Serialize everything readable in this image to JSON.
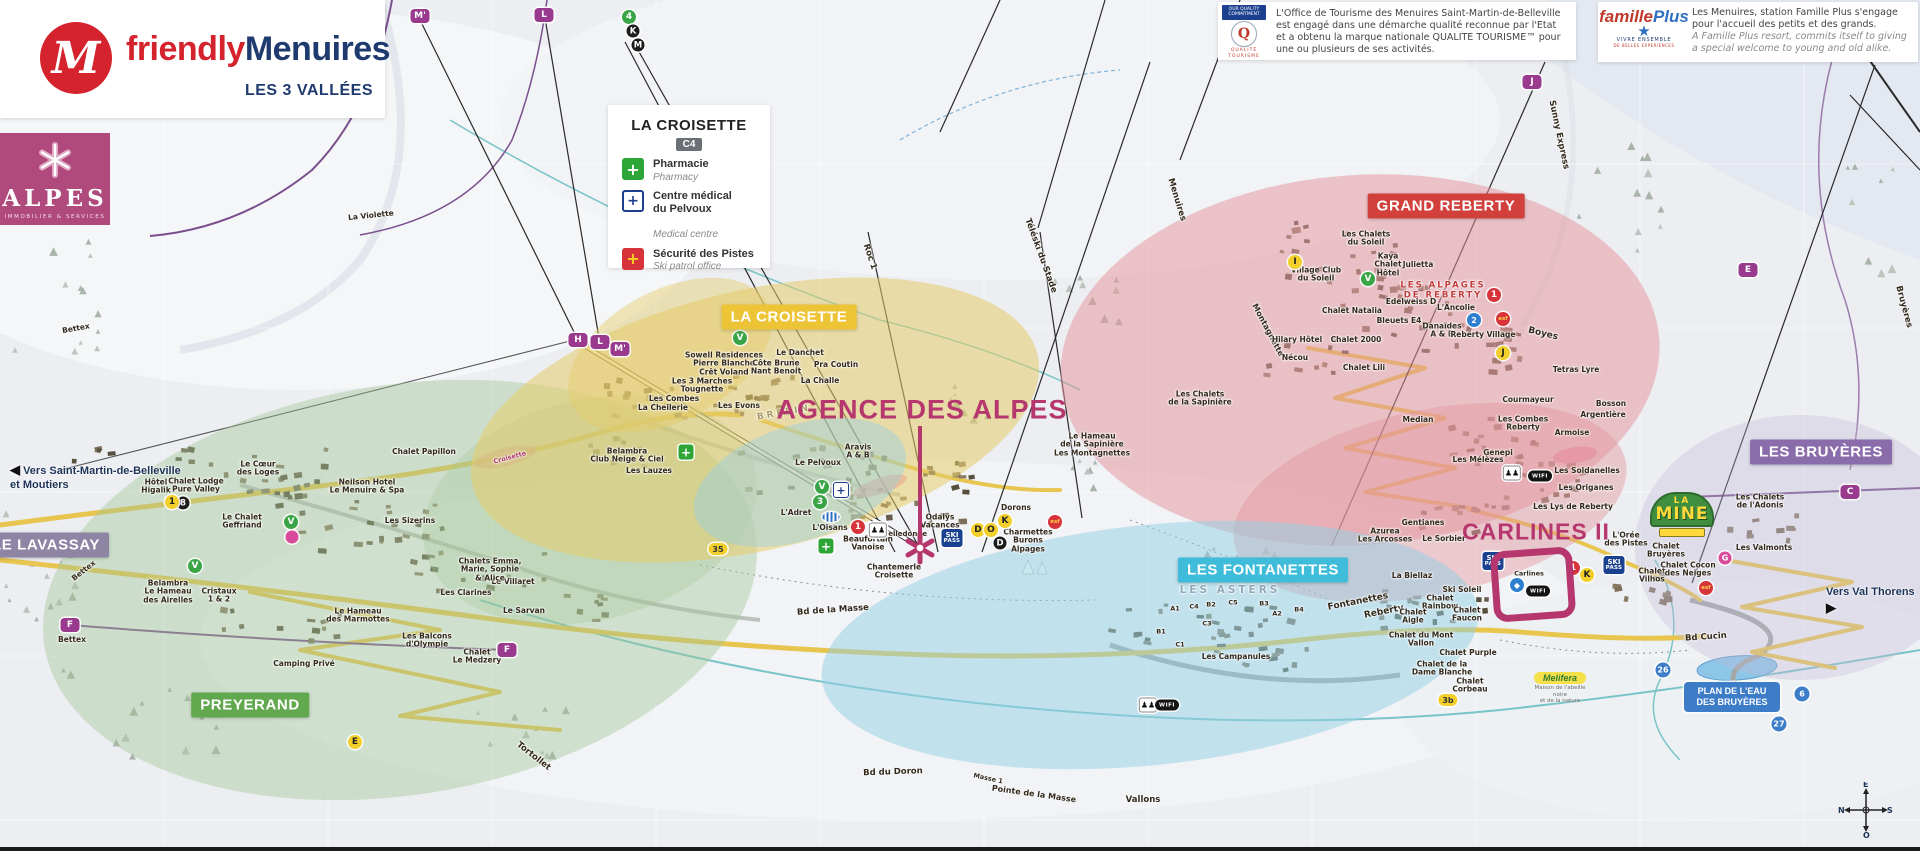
{
  "branding": {
    "m": "M",
    "friendly": "friendly",
    "menuires": "Menuires",
    "tagline": "LES 3 VALLÉES"
  },
  "alpes": {
    "title": "ALPES",
    "subtitle": "IMMOBILIER & SERVICES"
  },
  "legend": {
    "title": "LA CROISETTE",
    "grid_ref": "C4",
    "items": [
      {
        "fr": "Pharmacie",
        "en": "Pharmacy",
        "icon": "pharmacy-cross"
      },
      {
        "fr": "Centre médical\ndu Pelvoux",
        "en": "Medical centre",
        "icon": "medical-cross"
      },
      {
        "fr": "Sécurité des Pistes",
        "en": "Ski patrol office",
        "icon": "ski-patrol-cross"
      }
    ],
    "cross_glyph": "+"
  },
  "quality": {
    "badge_line1": "OUR QUALITY",
    "badge_line2": "COMMITMENT",
    "q": "Q",
    "logo_line1": "QUALITÉ",
    "logo_line2": "TOURISME",
    "text": "L'Office de Tourisme des Menuires Saint-Martin-de-Belleville est engagé dans une démarche qualité reconnue par l'Etat et a obtenu la marque nationale QUALITE TOURISME™ pour une ou plusieurs de ses activités."
  },
  "famille_plus": {
    "logo_f": "famille",
    "logo_p": "Plus",
    "star": "★",
    "sub1": "VIVRE ENSEMBLE",
    "sub2": "DE BELLES EXPERIENCES",
    "text_fr": "Les Menuires, station Famille Plus s'engage pour l'accueil des petits et des grands.",
    "text_en": "A Famille Plus resort, commits itself to giving a special welcome to young and old alike."
  },
  "callouts": {
    "agence": "AGENCE DES ALPES",
    "carlines": "CARLINES II"
  },
  "special": {
    "la_mine": {
      "l1": "LA",
      "l2": "MINE"
    },
    "plan_eau": {
      "l1": "PLAN DE L'EAU",
      "l2": "DES BRUYÈRES"
    },
    "melifera": {
      "name": "Melifera",
      "sub1": "Maison de l'abeille noire",
      "sub2": "et de la nature"
    },
    "ski_pass": {
      "l1": "SKI",
      "l2": "PASS"
    },
    "wifi": "WIFI",
    "people_glyph": "♟♟",
    "vers_left": {
      "arrow": "◀",
      "l1": "Vers Saint-Martin-de-Belleville",
      "l2": "et Moutiers"
    },
    "vers_right": {
      "label": "Vers Val Thorens",
      "arrow": "▶"
    },
    "compass": {
      "top": "E",
      "right": "S",
      "bottom": "O",
      "left": "N"
    }
  },
  "area_banners": [
    {
      "t": "LA CROISETTE",
      "x": 789,
      "y": 317,
      "bg": "#eec437",
      "n": "banner-la-croisette"
    },
    {
      "t": "GRAND REBERTY",
      "x": 1446,
      "y": 206,
      "bg": "#d2403c",
      "n": "banner-grand-reberty"
    },
    {
      "t": "LES BRUYÈRES",
      "x": 1821,
      "y": 452,
      "bg": "#8b6cab",
      "n": "banner-les-bruyeres"
    },
    {
      "t": "LES FONTANETTES",
      "x": 1263,
      "y": 570,
      "bg": "#3fbcd9",
      "n": "banner-les-fontanettes"
    },
    {
      "t": "PREYERAND",
      "x": 250,
      "y": 705,
      "bg": "#61a84f",
      "n": "banner-preyerand"
    },
    {
      "t": "LE LAVASSAY",
      "x": 46,
      "y": 545,
      "bg": "#8d85a3",
      "n": "banner-le-lavassay"
    }
  ],
  "map_labels": [
    {
      "t": "Le Cœur\ndes Loges",
      "x": 258,
      "y": 469
    },
    {
      "t": "Hôtel\nHigalik",
      "x": 156,
      "y": 487
    },
    {
      "t": "Chalet Lodge\nPure Valley",
      "x": 196,
      "y": 486
    },
    {
      "t": "Le Chalet\nGeffriand",
      "x": 242,
      "y": 522
    },
    {
      "t": "Belambra\nLe Hameau\ndes Airelles",
      "x": 168,
      "y": 592
    },
    {
      "t": "Cristaux\n1 & 2",
      "x": 219,
      "y": 596
    },
    {
      "t": "Le Hameau\ndes Marmottes",
      "x": 358,
      "y": 616
    },
    {
      "t": "Les Balcons\nd'Olympie",
      "x": 427,
      "y": 641
    },
    {
      "t": "Chalet\nLe Medzery",
      "x": 477,
      "y": 657
    },
    {
      "t": "Le Sarvan",
      "x": 524,
      "y": 611
    },
    {
      "t": "Camping Privé",
      "x": 304,
      "y": 664
    },
    {
      "t": "Les Clarines",
      "x": 466,
      "y": 593
    },
    {
      "t": "Le Villaret",
      "x": 513,
      "y": 582
    },
    {
      "t": "Chalets Emma,\nMarie, Sophie\n& Alice",
      "x": 490,
      "y": 570
    },
    {
      "t": "Les Sizerins",
      "x": 410,
      "y": 521
    },
    {
      "t": "Neilson Hotel\nLe Menuire & Spa",
      "x": 367,
      "y": 487
    },
    {
      "t": "Chalet Papillon",
      "x": 424,
      "y": 452
    },
    {
      "t": "Belambra\nClub Neige & Ciel",
      "x": 627,
      "y": 456
    },
    {
      "t": "Les Lauzes",
      "x": 649,
      "y": 471
    },
    {
      "t": "Bettex",
      "x": 76,
      "y": 329,
      "r": -10
    },
    {
      "t": "Bettex",
      "x": 84,
      "y": 571,
      "r": -38
    },
    {
      "t": "Bettex",
      "x": 72,
      "y": 640
    },
    {
      "t": "La Violette",
      "x": 371,
      "y": 216,
      "r": -6
    },
    {
      "t": "Tortollet",
      "x": 533,
      "y": 757,
      "r": 38,
      "s": 8.5
    },
    {
      "t": "Bd de la Masse",
      "x": 833,
      "y": 611,
      "r": -4,
      "s": 8.5
    },
    {
      "t": "Bd du Doron",
      "x": 893,
      "y": 773,
      "r": -2,
      "s": 8.5
    },
    {
      "t": "Vallons",
      "x": 1143,
      "y": 801,
      "s": 8.5
    },
    {
      "t": "Pointe de la Masse",
      "x": 1034,
      "y": 794,
      "r": 8,
      "s": 8
    },
    {
      "t": "Masse 1",
      "x": 988,
      "y": 779,
      "r": 12,
      "s": 6.5
    },
    {
      "t": "Sowell Residences\nPierre Blanche\nCrêt Voland",
      "x": 724,
      "y": 364
    },
    {
      "t": "Les 3 Marches\nTougnette",
      "x": 702,
      "y": 386
    },
    {
      "t": "Les Combes",
      "x": 674,
      "y": 399
    },
    {
      "t": "La Cheilerie",
      "x": 663,
      "y": 408
    },
    {
      "t": "Les Evons",
      "x": 739,
      "y": 406
    },
    {
      "t": "Le Danchet",
      "x": 800,
      "y": 353
    },
    {
      "t": "Côte Brune\nNant Benoit",
      "x": 776,
      "y": 368
    },
    {
      "t": "Pra Coutin",
      "x": 836,
      "y": 365
    },
    {
      "t": "La Challe",
      "x": 820,
      "y": 381
    },
    {
      "t": "BRELIN",
      "x": 784,
      "y": 413,
      "r": -10,
      "c": "#a89a66",
      "ls": 3,
      "s": 9
    },
    {
      "t": "L'Adret",
      "x": 796,
      "y": 513
    },
    {
      "t": "Le Pelvoux",
      "x": 818,
      "y": 463
    },
    {
      "t": "Aravis\nA & B",
      "x": 858,
      "y": 452
    },
    {
      "t": "Le Hameau\nde la Sapinière\nLes Montagnettes",
      "x": 1092,
      "y": 445
    },
    {
      "t": "Les Chalets\nde la Sapinière",
      "x": 1200,
      "y": 399
    },
    {
      "t": "Odalys\nVacances",
      "x": 940,
      "y": 522
    },
    {
      "t": "Belledonne",
      "x": 905,
      "y": 535,
      "s": 7
    },
    {
      "t": "Beaufortain\nVanoise",
      "x": 868,
      "y": 544
    },
    {
      "t": "Dorons",
      "x": 1016,
      "y": 508
    },
    {
      "t": "Charmettes\nBurons\nAlpages",
      "x": 1028,
      "y": 541
    },
    {
      "t": "L'Oisans",
      "x": 830,
      "y": 528
    },
    {
      "t": "Chantemerle\nCroisette",
      "x": 894,
      "y": 572
    },
    {
      "t": "Croisette",
      "x": 510,
      "y": 458,
      "r": -15,
      "s": 6.5,
      "c": "#b03a6d"
    },
    {
      "t": "Roc 1",
      "x": 869,
      "y": 257,
      "r": 72,
      "s": 8.5
    },
    {
      "t": "Téléski du Stade",
      "x": 1040,
      "y": 256,
      "r": 70,
      "s": 8.5
    },
    {
      "t": "Menuires",
      "x": 1176,
      "y": 200,
      "r": 73,
      "s": 8.5
    },
    {
      "t": "Sunny Express",
      "x": 1558,
      "y": 135,
      "r": 78,
      "s": 8.5
    },
    {
      "t": "Bruyères",
      "x": 1903,
      "y": 307,
      "r": 75,
      "s": 8.5
    },
    {
      "t": "Montagnette",
      "x": 1268,
      "y": 330,
      "r": 62,
      "s": 8
    },
    {
      "t": "Boyes",
      "x": 1543,
      "y": 334,
      "r": 14,
      "s": 9
    },
    {
      "t": "Les Chalets\ndu Soleil",
      "x": 1366,
      "y": 239
    },
    {
      "t": "Kaya\nChalet\nHôtel",
      "x": 1388,
      "y": 265
    },
    {
      "t": "Julietta",
      "x": 1418,
      "y": 265
    },
    {
      "t": "Village Club\ndu Soleil",
      "x": 1316,
      "y": 275
    },
    {
      "t": "LES ALPAGES\nDE REBERTY",
      "x": 1443,
      "y": 291,
      "c": "#c23d3d",
      "ls": 2,
      "s": 8.5
    },
    {
      "t": "Edelweiss D",
      "x": 1411,
      "y": 302
    },
    {
      "t": "L'Ancolie",
      "x": 1456,
      "y": 308
    },
    {
      "t": "Chalet Natalia",
      "x": 1352,
      "y": 311
    },
    {
      "t": "Bleuets E4",
      "x": 1399,
      "y": 321
    },
    {
      "t": "Danaïdes\nA & B",
      "x": 1442,
      "y": 331
    },
    {
      "t": "Reberty Village",
      "x": 1483,
      "y": 335
    },
    {
      "t": "Chalet 2000",
      "x": 1356,
      "y": 340
    },
    {
      "t": "Hilary Hôtel",
      "x": 1297,
      "y": 340
    },
    {
      "t": "Chalet Lili",
      "x": 1364,
      "y": 368
    },
    {
      "t": "Tetras Lyre",
      "x": 1576,
      "y": 370
    },
    {
      "t": "Nécou",
      "x": 1295,
      "y": 358
    },
    {
      "t": "Les Combes\nReberty",
      "x": 1523,
      "y": 424
    },
    {
      "t": "Courmayeur",
      "x": 1528,
      "y": 400
    },
    {
      "t": "Bosson",
      "x": 1611,
      "y": 404
    },
    {
      "t": "Argentière",
      "x": 1603,
      "y": 415
    },
    {
      "t": "Armoise",
      "x": 1572,
      "y": 433
    },
    {
      "t": "Genepi",
      "x": 1498,
      "y": 453
    },
    {
      "t": "Les Mélèzes",
      "x": 1478,
      "y": 460
    },
    {
      "t": "Les Soldanelles",
      "x": 1587,
      "y": 471
    },
    {
      "t": "Les Origanes",
      "x": 1586,
      "y": 488
    },
    {
      "t": "Les Lys de Reberty",
      "x": 1573,
      "y": 507
    },
    {
      "t": "Gentianes",
      "x": 1423,
      "y": 523
    },
    {
      "t": "Le Sorbier",
      "x": 1444,
      "y": 539
    },
    {
      "t": "Azurea\nLes Arcosses",
      "x": 1385,
      "y": 536
    },
    {
      "t": "Median",
      "x": 1418,
      "y": 420
    },
    {
      "t": "La Biellaz",
      "x": 1412,
      "y": 576
    },
    {
      "t": "LES ASTERS",
      "x": 1230,
      "y": 591,
      "c": "#8fa9ba",
      "ls": 3,
      "s": 10.5
    },
    {
      "t": "A1",
      "x": 1175,
      "y": 609,
      "s": 6.5
    },
    {
      "t": "C4",
      "x": 1194,
      "y": 607,
      "s": 6.5
    },
    {
      "t": "B2",
      "x": 1211,
      "y": 605,
      "s": 6.5
    },
    {
      "t": "C5",
      "x": 1233,
      "y": 603,
      "s": 6.5
    },
    {
      "t": "B3",
      "x": 1264,
      "y": 604,
      "s": 6.5
    },
    {
      "t": "A2",
      "x": 1277,
      "y": 614,
      "s": 6.5
    },
    {
      "t": "B4",
      "x": 1299,
      "y": 610,
      "s": 6.5
    },
    {
      "t": "C3",
      "x": 1207,
      "y": 624,
      "s": 6.5
    },
    {
      "t": "B1",
      "x": 1161,
      "y": 632,
      "s": 6.5
    },
    {
      "t": "C1",
      "x": 1180,
      "y": 645,
      "s": 6.5
    },
    {
      "t": "Les Campanules",
      "x": 1236,
      "y": 657
    },
    {
      "t": "Fontanettes",
      "x": 1358,
      "y": 602,
      "r": -11,
      "s": 9
    },
    {
      "t": "Reberty",
      "x": 1384,
      "y": 612,
      "r": -11,
      "s": 9
    },
    {
      "t": "Ski Soleil",
      "x": 1462,
      "y": 590
    },
    {
      "t": "Chalet\nRainbow",
      "x": 1440,
      "y": 603
    },
    {
      "t": "Chalet\nAigle",
      "x": 1413,
      "y": 617
    },
    {
      "t": "Chalet\nFaucon",
      "x": 1467,
      "y": 615
    },
    {
      "t": "Chalet du Mont\nVallon",
      "x": 1421,
      "y": 640
    },
    {
      "t": "Chalet Purple",
      "x": 1468,
      "y": 653
    },
    {
      "t": "Chalet de la\nDame Blanche",
      "x": 1442,
      "y": 669
    },
    {
      "t": "Chalet\nCorbeau",
      "x": 1470,
      "y": 686
    },
    {
      "t": "L'Orée\ndes Pistes",
      "x": 1626,
      "y": 540
    },
    {
      "t": "Chalet\nBruyères",
      "x": 1666,
      "y": 551
    },
    {
      "t": "Chalet\nVilhos",
      "x": 1652,
      "y": 576
    },
    {
      "t": "Chalet Cocon\ndes Neiges",
      "x": 1688,
      "y": 570
    },
    {
      "t": "Les Chalets\nde l'Adonis",
      "x": 1760,
      "y": 502
    },
    {
      "t": "Les Valmonts",
      "x": 1764,
      "y": 548
    },
    {
      "t": "Bd Cucin",
      "x": 1706,
      "y": 638,
      "r": -4,
      "s": 8.5
    },
    {
      "t": "Carlines",
      "x": 1529,
      "y": 574,
      "s": 6.5
    }
  ],
  "map_badges": [
    {
      "t": "M'",
      "x": 420,
      "y": 16,
      "k": "lift"
    },
    {
      "t": "L",
      "x": 544,
      "y": 15,
      "k": "lift"
    },
    {
      "t": "J",
      "x": 1532,
      "y": 82,
      "k": "lift"
    },
    {
      "t": "E",
      "x": 1748,
      "y": 270,
      "k": "lift"
    },
    {
      "t": "C",
      "x": 1850,
      "y": 492,
      "k": "lift"
    },
    {
      "t": "F",
      "x": 70,
      "y": 625,
      "k": "lift"
    },
    {
      "t": "F",
      "x": 507,
      "y": 650,
      "k": "lift"
    },
    {
      "t": "H",
      "x": 578,
      "y": 340,
      "k": "lift"
    },
    {
      "t": "L",
      "x": 600,
      "y": 342,
      "k": "lift"
    },
    {
      "t": "M'",
      "x": 620,
      "y": 349,
      "k": "lift"
    },
    {
      "t": "4",
      "x": 629,
      "y": 17,
      "k": "grn"
    },
    {
      "t": "V",
      "x": 740,
      "y": 338,
      "k": "grn"
    },
    {
      "t": "V",
      "x": 195,
      "y": 566,
      "k": "grn"
    },
    {
      "t": "V",
      "x": 291,
      "y": 522,
      "k": "grn"
    },
    {
      "t": "V",
      "x": 1368,
      "y": 279,
      "k": "grn"
    },
    {
      "t": "V",
      "x": 822,
      "y": 487,
      "k": "grn"
    },
    {
      "t": "3",
      "x": 820,
      "y": 502,
      "k": "grn"
    },
    {
      "t": "K",
      "x": 633,
      "y": 31,
      "k": "blk"
    },
    {
      "t": "M",
      "x": 638,
      "y": 45,
      "k": "blk"
    },
    {
      "t": "8",
      "x": 183,
      "y": 503,
      "k": "blk"
    },
    {
      "t": "D",
      "x": 1000,
      "y": 543,
      "k": "blk"
    },
    {
      "t": "1",
      "x": 172,
      "y": 502,
      "k": "yel"
    },
    {
      "t": "I",
      "x": 1295,
      "y": 262,
      "k": "yel"
    },
    {
      "t": "J",
      "x": 1503,
      "y": 353,
      "k": "yel"
    },
    {
      "t": "D",
      "x": 978,
      "y": 530,
      "k": "yel"
    },
    {
      "t": "O",
      "x": 991,
      "y": 530,
      "k": "yel"
    },
    {
      "t": "K",
      "x": 1005,
      "y": 521,
      "k": "yel"
    },
    {
      "t": "E",
      "x": 355,
      "y": 742,
      "k": "yel"
    },
    {
      "t": "K",
      "x": 1587,
      "y": 575,
      "k": "yel"
    },
    {
      "t": "1",
      "x": 1494,
      "y": 295,
      "k": "red"
    },
    {
      "t": "1",
      "x": 858,
      "y": 527,
      "k": "red"
    },
    {
      "t": "1",
      "x": 1573,
      "y": 568,
      "k": "red"
    },
    {
      "t": "2",
      "x": 1474,
      "y": 320,
      "k": "blu"
    },
    {
      "t": "◆",
      "x": 1517,
      "y": 585,
      "k": "blu"
    },
    {
      "t": "35",
      "x": 718,
      "y": 549,
      "k": "rdY"
    },
    {
      "t": "3b",
      "x": 1448,
      "y": 700,
      "k": "rdY"
    },
    {
      "t": "26",
      "x": 1663,
      "y": 670,
      "k": "rdB"
    },
    {
      "t": "6",
      "x": 1802,
      "y": 694,
      "k": "rdB"
    },
    {
      "t": "27",
      "x": 1779,
      "y": 724,
      "k": "rdB"
    },
    {
      "t": "esf",
      "x": 1055,
      "y": 522,
      "k": "esf"
    },
    {
      "t": "esf",
      "x": 1503,
      "y": 319,
      "k": "esf"
    },
    {
      "t": "esf",
      "x": 1706,
      "y": 588,
      "k": "esf"
    },
    {
      "t": "G",
      "x": 1725,
      "y": 558,
      "k": "mag"
    },
    {
      "t": "",
      "x": 292,
      "y": 537,
      "k": "mag"
    },
    {
      "t": "",
      "x": 878,
      "y": 530,
      "k": "ppl"
    },
    {
      "t": "",
      "x": 1512,
      "y": 473,
      "k": "ppl"
    },
    {
      "t": "",
      "x": 1148,
      "y": 705,
      "k": "ppl"
    },
    {
      "t": "",
      "x": 1167,
      "y": 705,
      "k": "wifi"
    },
    {
      "t": "",
      "x": 1540,
      "y": 476,
      "k": "wifi"
    },
    {
      "t": "",
      "x": 1538,
      "y": 591,
      "k": "wifi"
    },
    {
      "t": "",
      "x": 952,
      "y": 538,
      "k": "skp"
    },
    {
      "t": "",
      "x": 1493,
      "y": 561,
      "k": "skp"
    },
    {
      "t": "",
      "x": 1614,
      "y": 565,
      "k": "skp"
    },
    {
      "t": "+",
      "x": 826,
      "y": 546,
      "k": "phg"
    },
    {
      "t": "+",
      "x": 686,
      "y": 452,
      "k": "phg"
    },
    {
      "t": "+",
      "x": 841,
      "y": 490,
      "k": "phb"
    },
    {
      "t": "",
      "x": 831,
      "y": 517,
      "k": "pool"
    }
  ]
}
